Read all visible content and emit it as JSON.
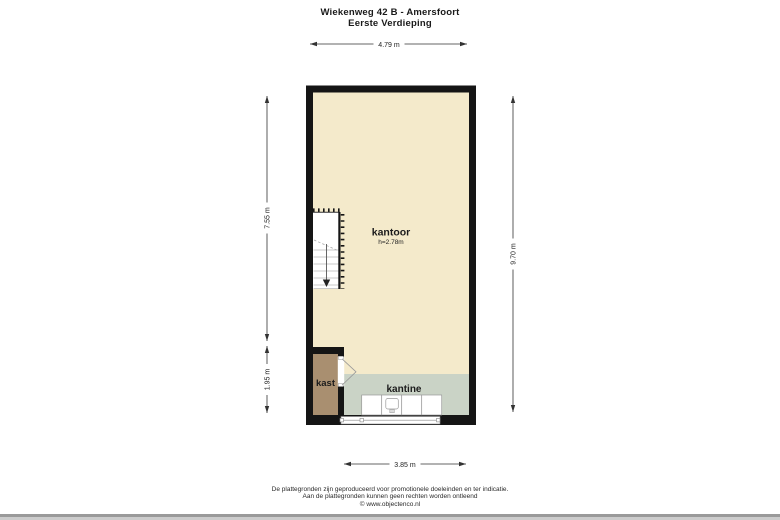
{
  "page": {
    "title_line1": "Wiekenweg 42 B - Amersfoort",
    "title_line2": "Eerste Verdieping"
  },
  "floorplan": {
    "rooms": {
      "kantoor": {
        "label": "kantoor",
        "ceiling_height": "h=2.78m"
      },
      "kast": {
        "label": "kast"
      },
      "kantine": {
        "label": "kantine"
      }
    },
    "dimensions": {
      "top_width": "4.79 m",
      "left_upper_height": "7.55 m",
      "left_lower_height": "1.95 m",
      "right_height": "9.70 m",
      "bottom_width": "3.85 m"
    },
    "colors": {
      "wall": "#151515",
      "floor": "#f4eacb",
      "kast_floor": "#a98f70",
      "kantine_floor": "#cad3c6"
    }
  },
  "footer": {
    "line1": "De plattegronden zijn geproduceerd voor promotionele doeleinden en ter indicatie.",
    "line2": "Aan de plattegronden kunnen geen rechten worden ontleend",
    "line3": "© www.objectenco.nl"
  }
}
